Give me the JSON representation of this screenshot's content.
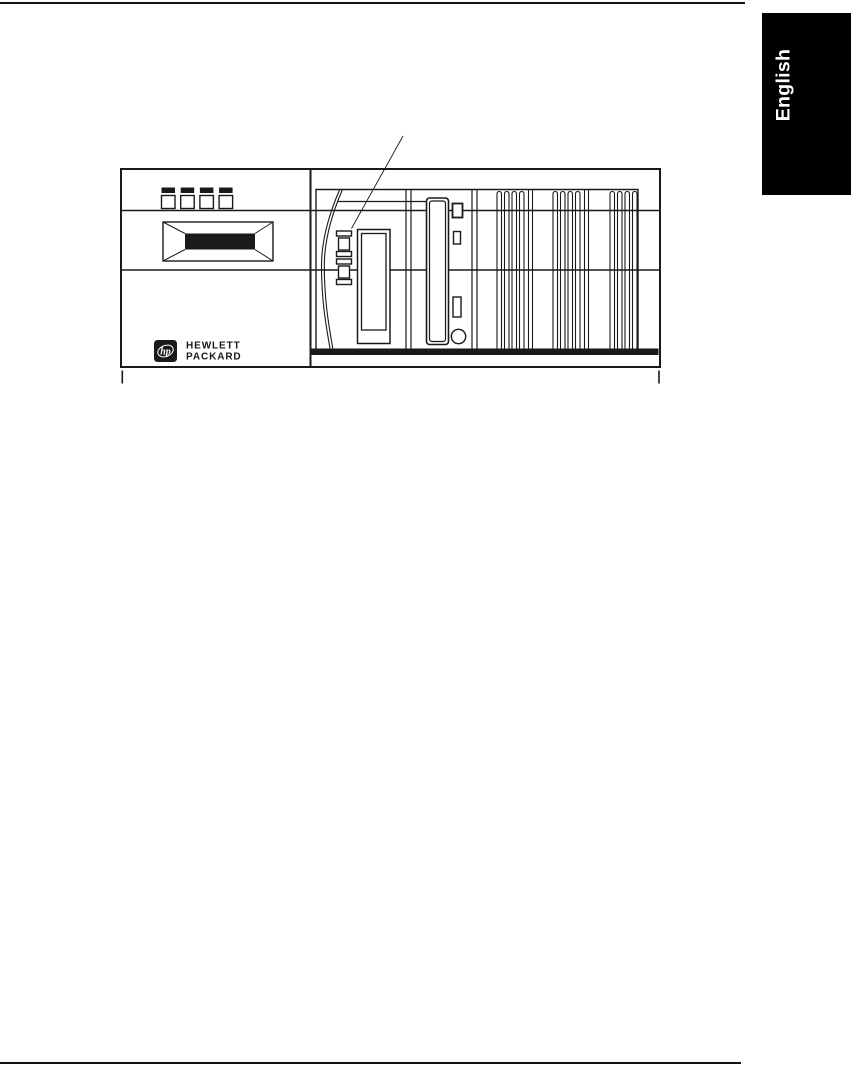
{
  "tab": {
    "label": "English",
    "bg": "#000000",
    "fg": "#ffffff"
  },
  "brand": {
    "logo_text": "hp",
    "line1": "HEWLETT",
    "line2": "PACKARD"
  },
  "figure": {
    "parts": {
      "callout-line": "thin diagonal leader line pointing to upper eject button",
      "control-panel-buttons": "four small squares with black bars above",
      "lcd-display": "beveled rectangle with black screen",
      "hp-logo": "black rounded square with white hp oval",
      "cable": "double curved line",
      "eject-buttons": "two stacked push buttons",
      "tape-drive-bay": "tall rectangular slot",
      "cd-rom-drive": "tall rounded-rectangle drive with LED, eject slot and round button",
      "vent-grilles": "three groups of vertical slots",
      "base-bar": "solid black horizontal bar at panel bottom"
    }
  },
  "colors": {
    "ink": "#1a1a1a",
    "paper": "#ffffff",
    "tab_bg": "#000000",
    "tab_fg": "#ffffff"
  }
}
